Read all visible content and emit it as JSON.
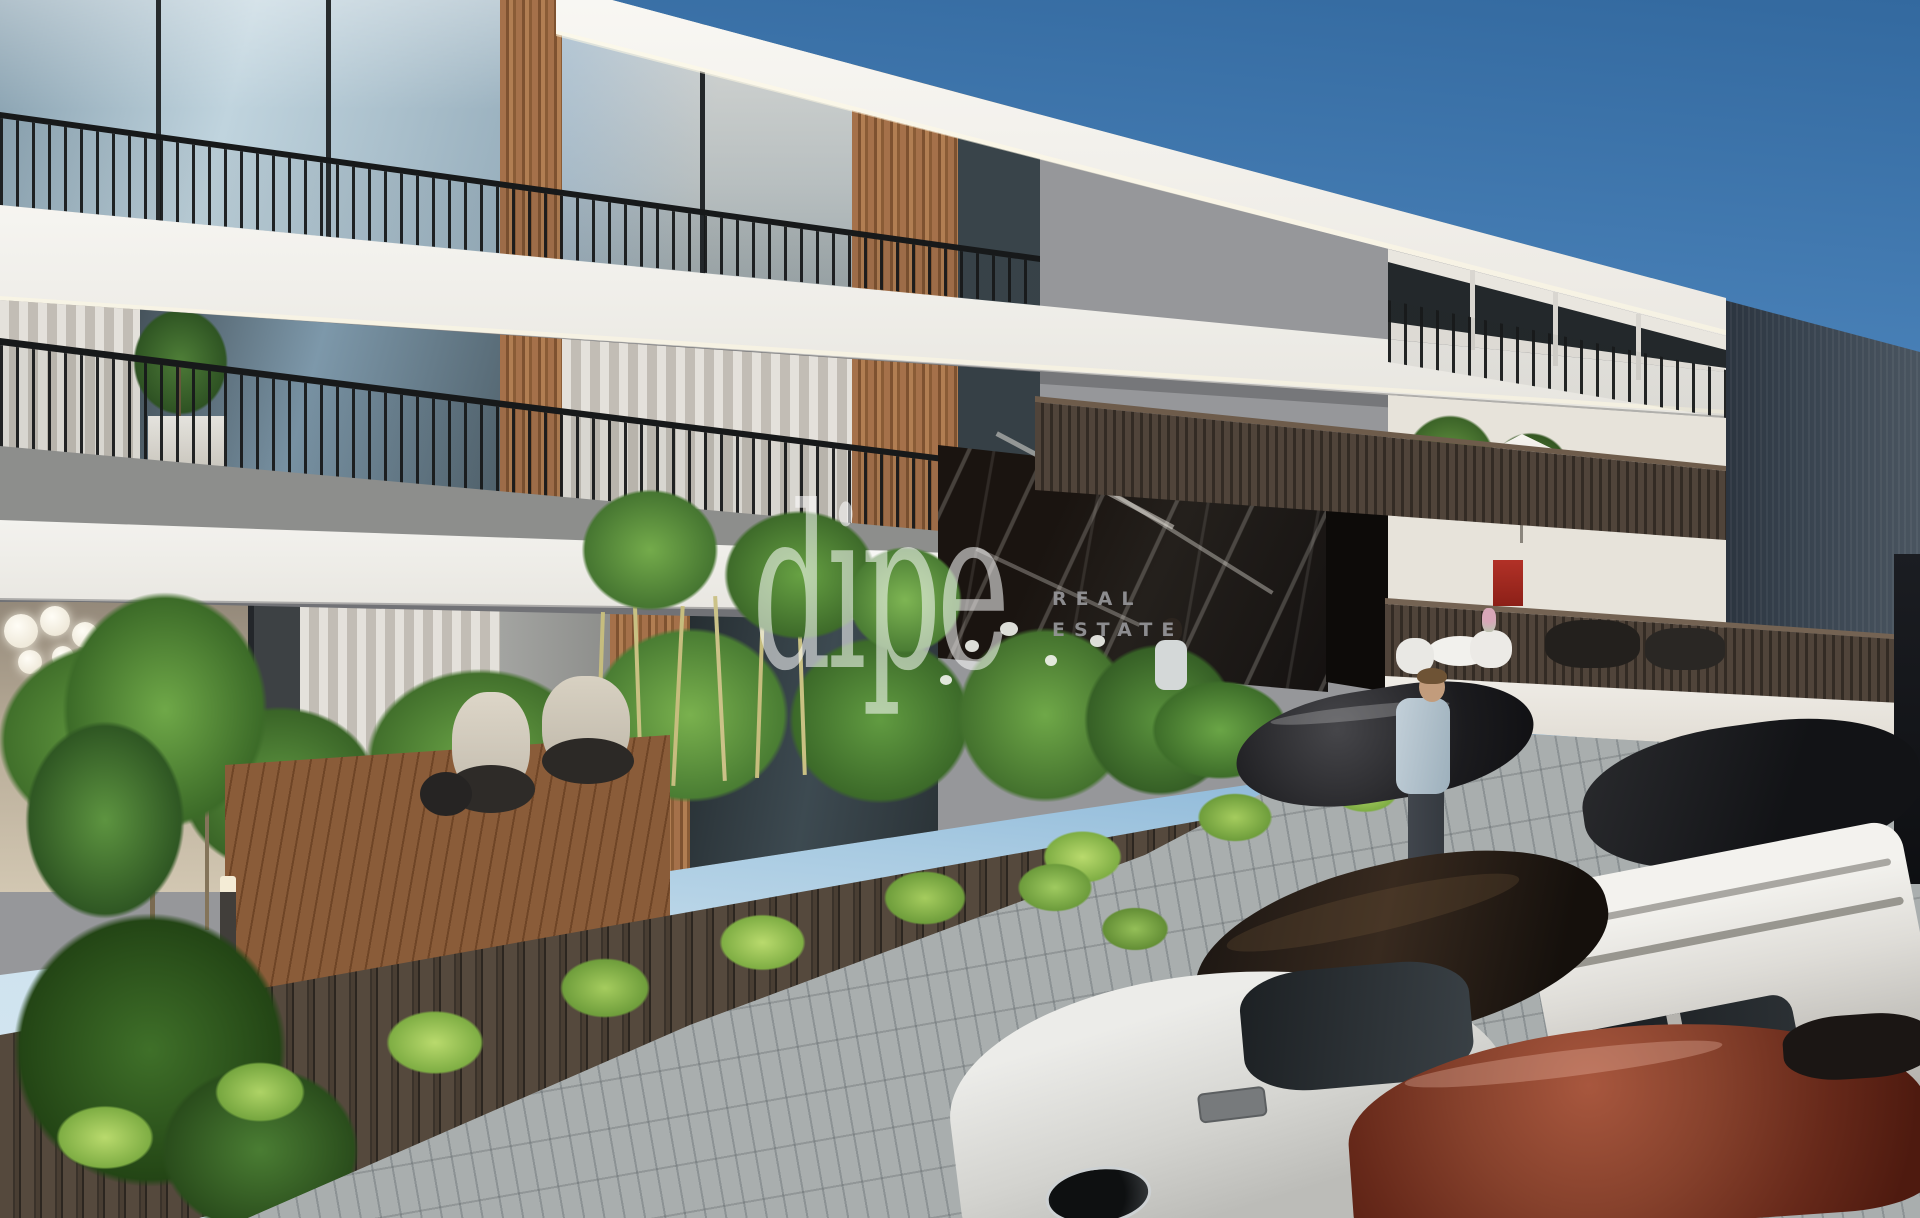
{
  "meta": {
    "description": "Sunny 3D architectural exterior render of a modern three-storey apartment building with wood-slat accents, black balcony railings, front gardens, a slatted timber fence, cobbled driveway and a row of parked cars"
  },
  "watermark": {
    "logo": "dipe",
    "tagline_line1": "REAL",
    "tagline_line2": "ESTATE"
  },
  "palette": {
    "sky_top": "#33699f",
    "sky_horizon": "#cfe3ef",
    "slab_white": "#f3f2ee",
    "facade_gray": "#8d8e8c",
    "window_frame": "#23272a",
    "wood_slats": "#a5714a",
    "railing_black": "#17191a",
    "balustrade_brown": "#50443a",
    "marble_black": "#17120e",
    "hedge_green": "#68a143",
    "fence_brown": "#4a4034",
    "pavement_gray": "#a9aeae",
    "deck_wood": "#8a5c39",
    "umbrella_white": "#f3f1ea",
    "warehouse_gray": "#37424e",
    "car_silver": "#d3d3cf",
    "car_maroon": "#86412c",
    "car_white_suv": "#e8e7e3",
    "car_black": "#1b1b1e",
    "car_espresso": "#241b14"
  }
}
